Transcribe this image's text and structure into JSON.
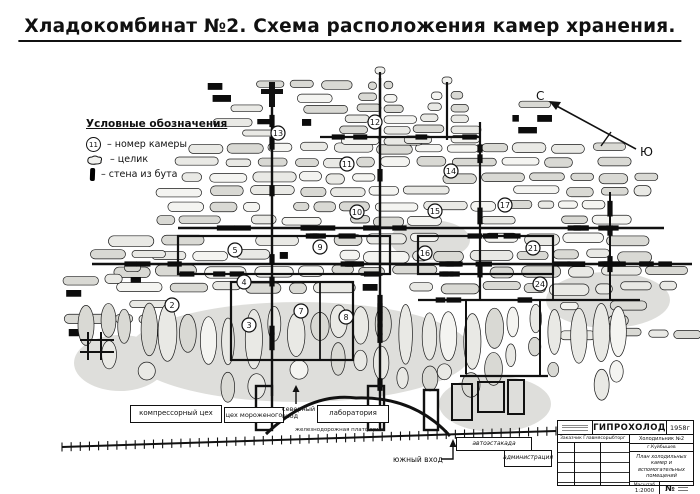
{
  "page": {
    "title": "Хладокомбинат №2. Схема расположения камер хранения."
  },
  "legend": {
    "title": "Условные обозначения",
    "chamber_symbol": "11",
    "items": [
      {
        "symbol": "chamber-number-circle",
        "label": "– номер камеры"
      },
      {
        "symbol": "pillar-blob",
        "label": "– целик"
      },
      {
        "symbol": "rubble-wall-bar",
        "label": "– стена из бута"
      }
    ]
  },
  "compass": {
    "north": "С",
    "south": "Ю"
  },
  "map": {
    "chambers": [
      {
        "n": "2",
        "x": 172,
        "y": 305
      },
      {
        "n": "3",
        "x": 249,
        "y": 325
      },
      {
        "n": "4",
        "x": 244,
        "y": 282
      },
      {
        "n": "5",
        "x": 235,
        "y": 250
      },
      {
        "n": "7",
        "x": 301,
        "y": 311
      },
      {
        "n": "8",
        "x": 346,
        "y": 317
      },
      {
        "n": "9",
        "x": 320,
        "y": 247
      },
      {
        "n": "10",
        "x": 357,
        "y": 212
      },
      {
        "n": "11",
        "x": 347,
        "y": 164
      },
      {
        "n": "12",
        "x": 375,
        "y": 122
      },
      {
        "n": "13",
        "x": 278,
        "y": 133
      },
      {
        "n": "14",
        "x": 451,
        "y": 171
      },
      {
        "n": "15",
        "x": 435,
        "y": 211
      },
      {
        "n": "16",
        "x": 425,
        "y": 253
      },
      {
        "n": "17",
        "x": 505,
        "y": 205
      },
      {
        "n": "21",
        "x": 533,
        "y": 248
      },
      {
        "n": "24",
        "x": 540,
        "y": 284
      }
    ]
  },
  "buildings": {
    "compressor": "компрессорный цех",
    "icecream": "цех мороженого",
    "lab": "лаборатория",
    "ramp": "автоэстакада",
    "admin": "администрация"
  },
  "entrances": {
    "north": "северный вход",
    "south": "южный вход"
  },
  "railroad": {
    "label": "железнодорожная платформа"
  },
  "title_block": {
    "org": "ГИПРОХОЛОД",
    "year": "1958г",
    "customer_row": "Заказчик  Главмясорыбторг",
    "object_line1": "Холодильник №2",
    "object_line2": "г.Куйбышев",
    "doc_title": "План холодильных камер и вспомогательных помещений",
    "scale_label": "Масштаб",
    "scale_value": "1:2000",
    "sheet_label": "№"
  },
  "colors": {
    "ink": "#111111",
    "pillar_fill": "#e9e9e5",
    "pillar_shade": "#d9d9d4"
  }
}
